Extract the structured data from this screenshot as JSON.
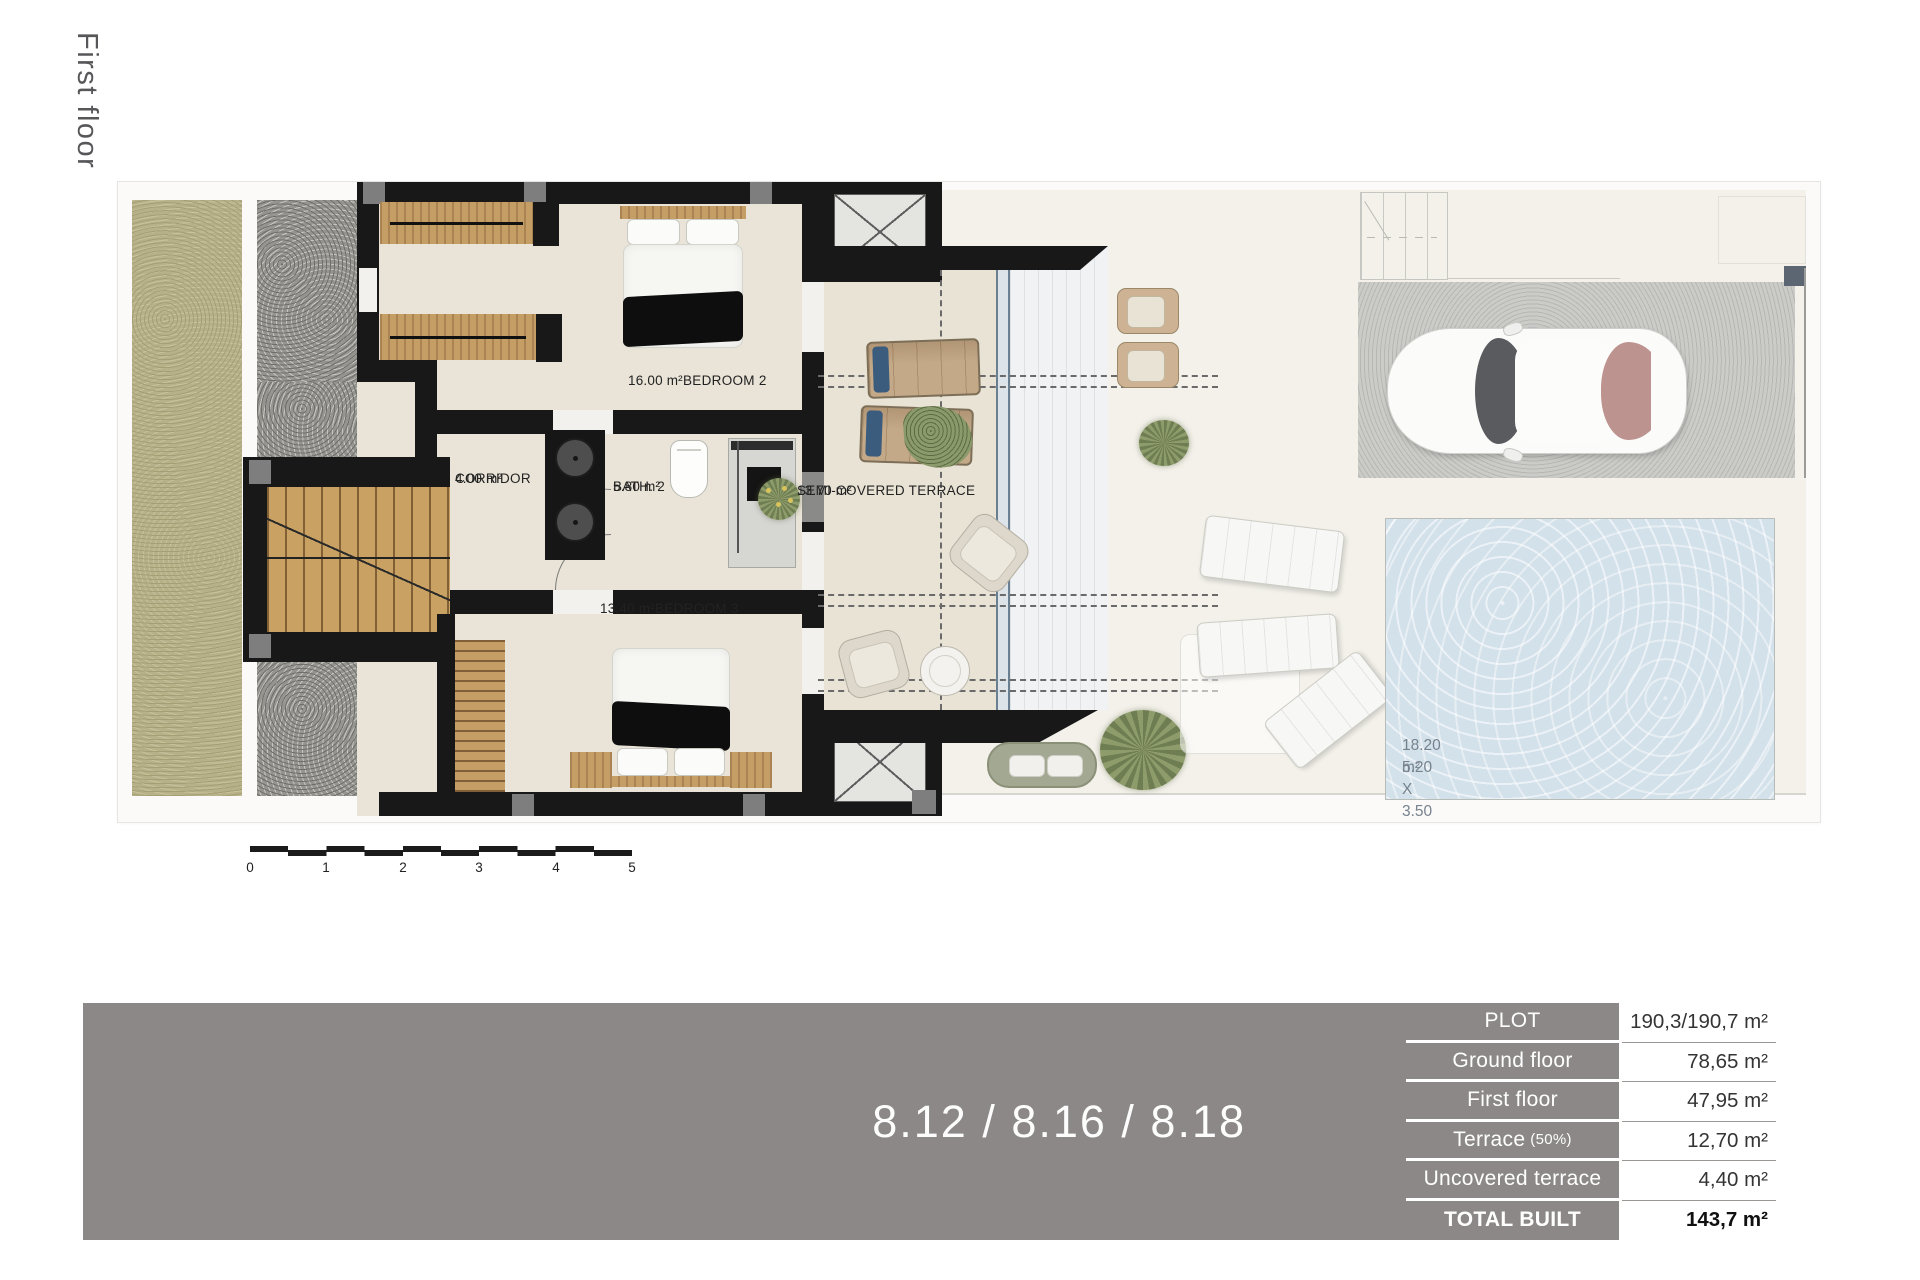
{
  "page": {
    "floor_label": "First floor"
  },
  "plan": {
    "rooms": [
      {
        "name": "BEDROOM 2",
        "area": "16.00 m²"
      },
      {
        "name": "CORRIDOR",
        "area": "4.00 m²"
      },
      {
        "name": "BATH. 2",
        "area": "5.80 m²"
      },
      {
        "name": "BEDROOM 3",
        "area": "13.40 m²"
      },
      {
        "name": "SEMI-COVERED TERRACE",
        "area": "13.70 m²"
      }
    ],
    "pool": {
      "area": "18.20 m²",
      "dimensions": "5.20 X 3.50"
    }
  },
  "scale_bar": {
    "labels": [
      "0",
      "1",
      "2",
      "3",
      "4",
      "5"
    ]
  },
  "footer": {
    "units_label": "8.12 / 8.16 / 8.18",
    "table": {
      "rows": [
        {
          "label": "PLOT",
          "value": "190,3/190,7 m²"
        },
        {
          "label": "Ground floor",
          "value": "78,65 m²"
        },
        {
          "label": "First floor",
          "value": "47,95 m²"
        },
        {
          "label": "Terrace",
          "label_note": "(50%)",
          "value": "12,70 m²"
        },
        {
          "label": "Uncovered terrace",
          "value": "4,40 m²"
        },
        {
          "label": "TOTAL BUILT",
          "value": "143,7 m²"
        }
      ]
    }
  },
  "colors": {
    "brand_gray": "#8b8887",
    "wall_black": "#181818",
    "pool_blue": "#d3e1ea",
    "wood": "#c59e66",
    "grass": "#b7b189"
  }
}
